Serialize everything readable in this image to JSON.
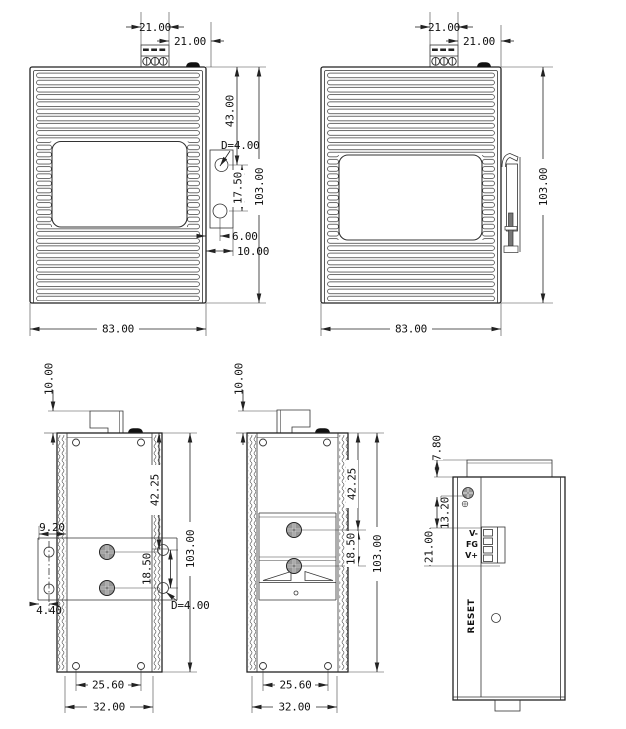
{
  "colors": {
    "line": "#222222",
    "paper": "#ffffff",
    "screw_fill": "#969696"
  },
  "views": {
    "front_a": {
      "dims": {
        "terminal_width": "21.00",
        "terminal_offset": "21.00",
        "hole_from_top": "43.00",
        "hole_diameter": "D=4.00",
        "hole_pitch": "17.50",
        "height": "103.00",
        "hole_inset": "6.00",
        "flange_offset": "10.00",
        "width": "83.00"
      }
    },
    "front_b": {
      "dims": {
        "terminal_width": "21.00",
        "terminal_offset": "21.00",
        "height": "103.00",
        "width": "83.00"
      }
    },
    "side_a": {
      "dims": {
        "terminal_tab": "10.00",
        "upper_hole": "42.25",
        "plate_overhang": "9.20",
        "hole_pitch": "18.50",
        "height": "103.00",
        "hole_edge_offset": "4.40",
        "hole_diameter": "D=4.00",
        "hole_span": "25.60",
        "depth": "32.00"
      }
    },
    "side_b": {
      "dims": {
        "terminal_tab": "10.00",
        "upper_screw": "42.25",
        "screw_pitch": "18.50",
        "height": "103.00",
        "hole_span": "25.60",
        "depth": "32.00"
      }
    },
    "top": {
      "dims": {
        "lip": "7.80",
        "ground_screw_offset": "13.20",
        "terminal_height": "21.00"
      },
      "terminal_labels": [
        "V-",
        "FG",
        "V+"
      ],
      "reset_label": "RESET"
    }
  }
}
